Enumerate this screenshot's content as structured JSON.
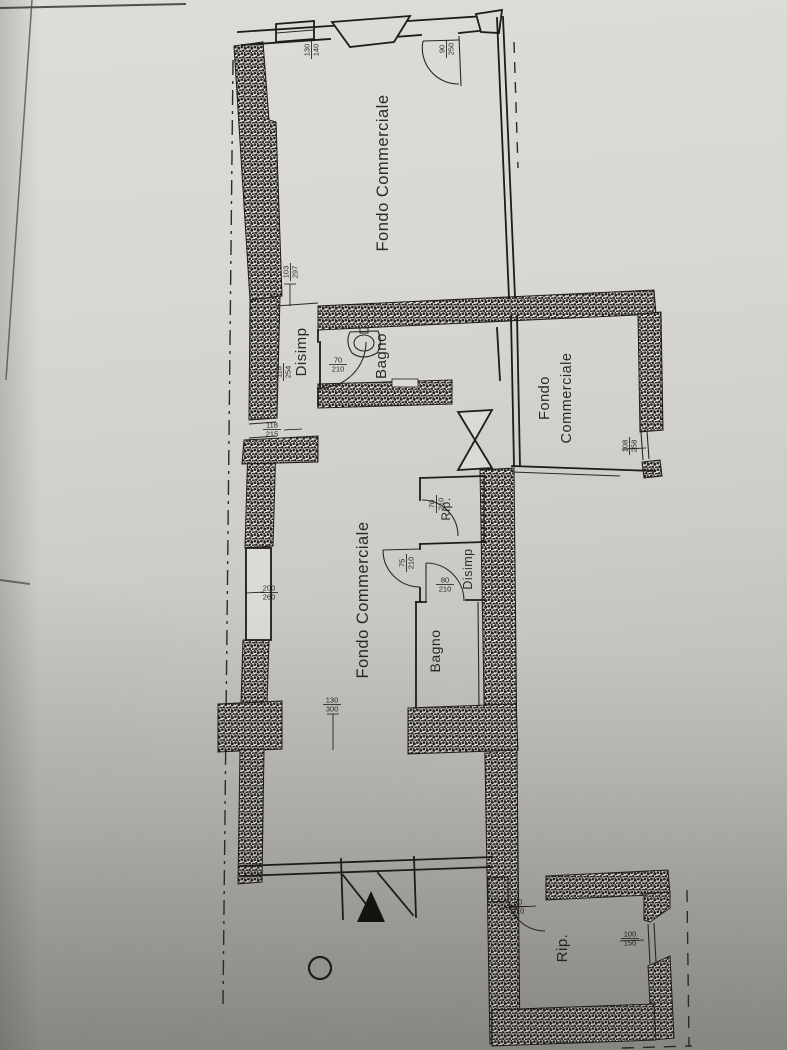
{
  "document": {
    "kind": "scanned floor plan (planimetria catastale)",
    "language": "it"
  },
  "colors": {
    "paper_top": "#dedcd8",
    "paper_bottom": "#9b9994",
    "ink": "#1e1c19"
  },
  "rooms": {
    "fondo1": "Fondo Commerciale",
    "disimp1": "Disimp",
    "bagno1": "Bagno",
    "fondo2_l1": "Fondo",
    "fondo2_l2": "Commerciale",
    "fondo3": "Fondo Commerciale",
    "rip1": "Rip.",
    "disimp2": "Disimp",
    "bagno2": "Bagno",
    "rip2": "Rip."
  },
  "dims": {
    "top_door": {
      "w": "90",
      "h": "250"
    },
    "shop_window": {
      "w": "130",
      "h": "140"
    },
    "disimp1_top": {
      "w": "103",
      "h": "297"
    },
    "disimp1_left": {
      "w": "118",
      "h": "254"
    },
    "bagno1_door": {
      "w": "70",
      "h": "210"
    },
    "left_window1": {
      "w": "118",
      "h": "215"
    },
    "fondo2_window": {
      "w": "108",
      "h": "258"
    },
    "left_window2": {
      "w": "200",
      "h": "260"
    },
    "mid_opening": {
      "w": "130",
      "h": "300"
    },
    "rip1_door": {
      "w": "70",
      "h": "210"
    },
    "disimp2_door": {
      "w": "75",
      "h": "210"
    },
    "bagno2_door": {
      "w": "80",
      "h": "210"
    },
    "rip2_door": {
      "w": "80",
      "h": "210"
    },
    "rip2_window": {
      "w": "100",
      "h": "150"
    }
  }
}
